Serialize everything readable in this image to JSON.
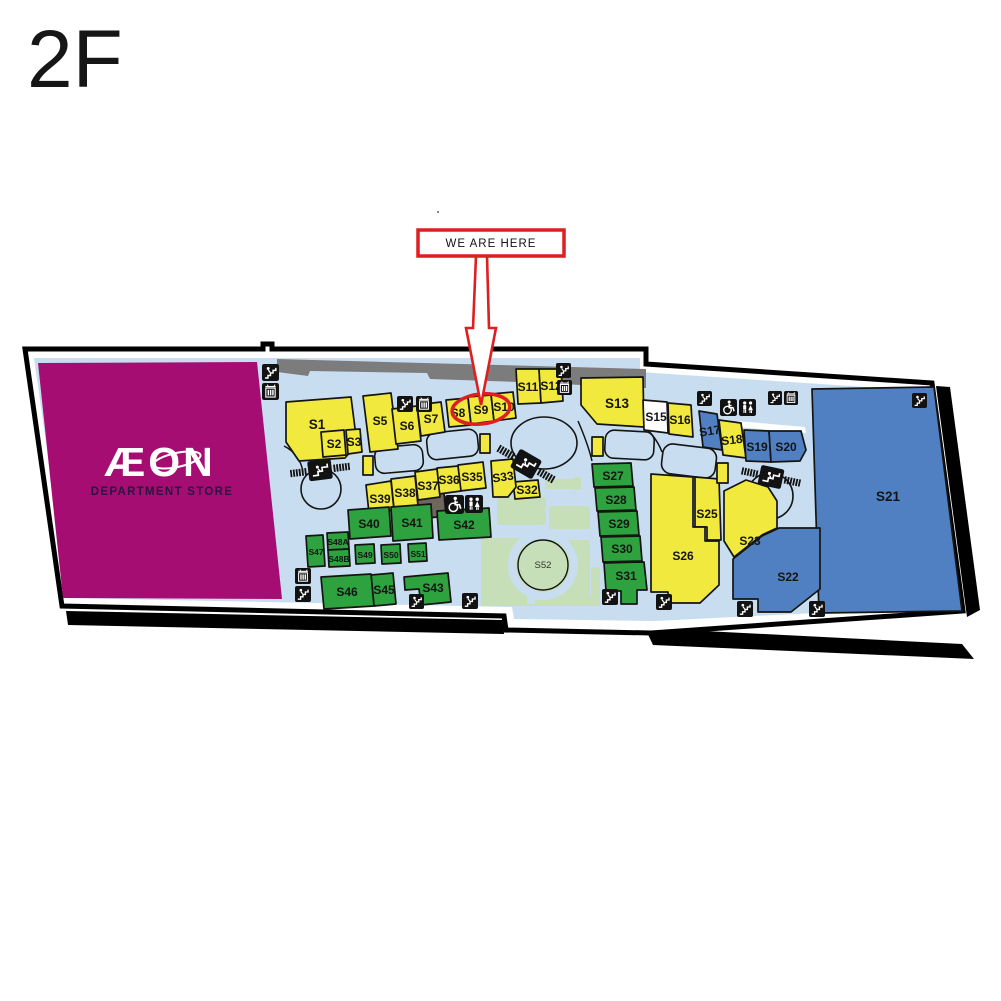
{
  "floor_label": "2F",
  "marker": {
    "label": "WE ARE HERE",
    "highlighted_shop": "S9"
  },
  "anchor_store": {
    "name": "ÆON",
    "subtitle": "DEPARTMENT STORE"
  },
  "palette": {
    "shop_yellow": "#F2E93F",
    "shop_green": "#2EA23E",
    "shop_blue": "#5080C2",
    "shop_white": "#FFFFFF",
    "walkway_blue": "#C8DEF0",
    "garden_green": "#C6DFB8",
    "anchor_magenta": "#A50D72",
    "marker_red": "#DD1F1F",
    "roof_gray": "#7C7C7C"
  },
  "icons_legend": [
    "stairs-icon",
    "elevator-icon",
    "toilet-icon",
    "wheelchair-icon",
    "escalator-icon"
  ],
  "shops": [
    {
      "id": "S1",
      "label": "S1",
      "category": "yellow"
    },
    {
      "id": "S2",
      "label": "S2",
      "category": "yellow"
    },
    {
      "id": "S3",
      "label": "S3",
      "category": "yellow"
    },
    {
      "id": "S5",
      "label": "S5",
      "category": "yellow"
    },
    {
      "id": "S6",
      "label": "S6",
      "category": "yellow"
    },
    {
      "id": "S7",
      "label": "S7",
      "category": "yellow"
    },
    {
      "id": "S8",
      "label": "S8",
      "category": "yellow"
    },
    {
      "id": "S9",
      "label": "S9",
      "category": "yellow",
      "highlighted": true
    },
    {
      "id": "S10",
      "label": "S10",
      "category": "yellow"
    },
    {
      "id": "S11",
      "label": "S11",
      "category": "yellow"
    },
    {
      "id": "S12",
      "label": "S12",
      "category": "yellow"
    },
    {
      "id": "S13",
      "label": "S13",
      "category": "yellow"
    },
    {
      "id": "S15",
      "label": "S15",
      "category": "white"
    },
    {
      "id": "S16",
      "label": "S16",
      "category": "yellow"
    },
    {
      "id": "S17",
      "label": "S17",
      "category": "blue"
    },
    {
      "id": "S18",
      "label": "S18",
      "category": "yellow"
    },
    {
      "id": "S19",
      "label": "S19",
      "category": "blue"
    },
    {
      "id": "S20",
      "label": "S20",
      "category": "blue"
    },
    {
      "id": "S21",
      "label": "S21",
      "category": "blue"
    },
    {
      "id": "S22",
      "label": "S22",
      "category": "blue"
    },
    {
      "id": "S23",
      "label": "S23",
      "category": "yellow"
    },
    {
      "id": "S25",
      "label": "S25",
      "category": "yellow"
    },
    {
      "id": "S26",
      "label": "S26",
      "category": "yellow"
    },
    {
      "id": "S27",
      "label": "S27",
      "category": "green"
    },
    {
      "id": "S28",
      "label": "S28",
      "category": "green"
    },
    {
      "id": "S29",
      "label": "S29",
      "category": "green"
    },
    {
      "id": "S30",
      "label": "S30",
      "category": "green"
    },
    {
      "id": "S31",
      "label": "S31",
      "category": "green"
    },
    {
      "id": "S32",
      "label": "S32",
      "category": "yellow"
    },
    {
      "id": "S33",
      "label": "S33",
      "category": "yellow"
    },
    {
      "id": "S35",
      "label": "S35",
      "category": "yellow"
    },
    {
      "id": "S36",
      "label": "S36",
      "category": "yellow"
    },
    {
      "id": "S37",
      "label": "S37",
      "category": "yellow"
    },
    {
      "id": "S38",
      "label": "S38",
      "category": "yellow"
    },
    {
      "id": "S39",
      "label": "S39",
      "category": "yellow"
    },
    {
      "id": "S40",
      "label": "S40",
      "category": "green"
    },
    {
      "id": "S41",
      "label": "S41",
      "category": "green"
    },
    {
      "id": "S42",
      "label": "S42",
      "category": "green"
    },
    {
      "id": "S43",
      "label": "S43",
      "category": "green"
    },
    {
      "id": "S45",
      "label": "S45",
      "category": "green"
    },
    {
      "id": "S46",
      "label": "S46",
      "category": "green"
    },
    {
      "id": "S47",
      "label": "S47",
      "category": "green"
    },
    {
      "id": "S48A",
      "label": "S48A",
      "category": "green"
    },
    {
      "id": "S48B",
      "label": "S48B",
      "category": "green"
    },
    {
      "id": "S49",
      "label": "S49",
      "category": "green"
    },
    {
      "id": "S50",
      "label": "S50",
      "category": "green"
    },
    {
      "id": "S51",
      "label": "S51",
      "category": "green"
    },
    {
      "id": "S52",
      "label": "S52",
      "category": "garden"
    }
  ]
}
